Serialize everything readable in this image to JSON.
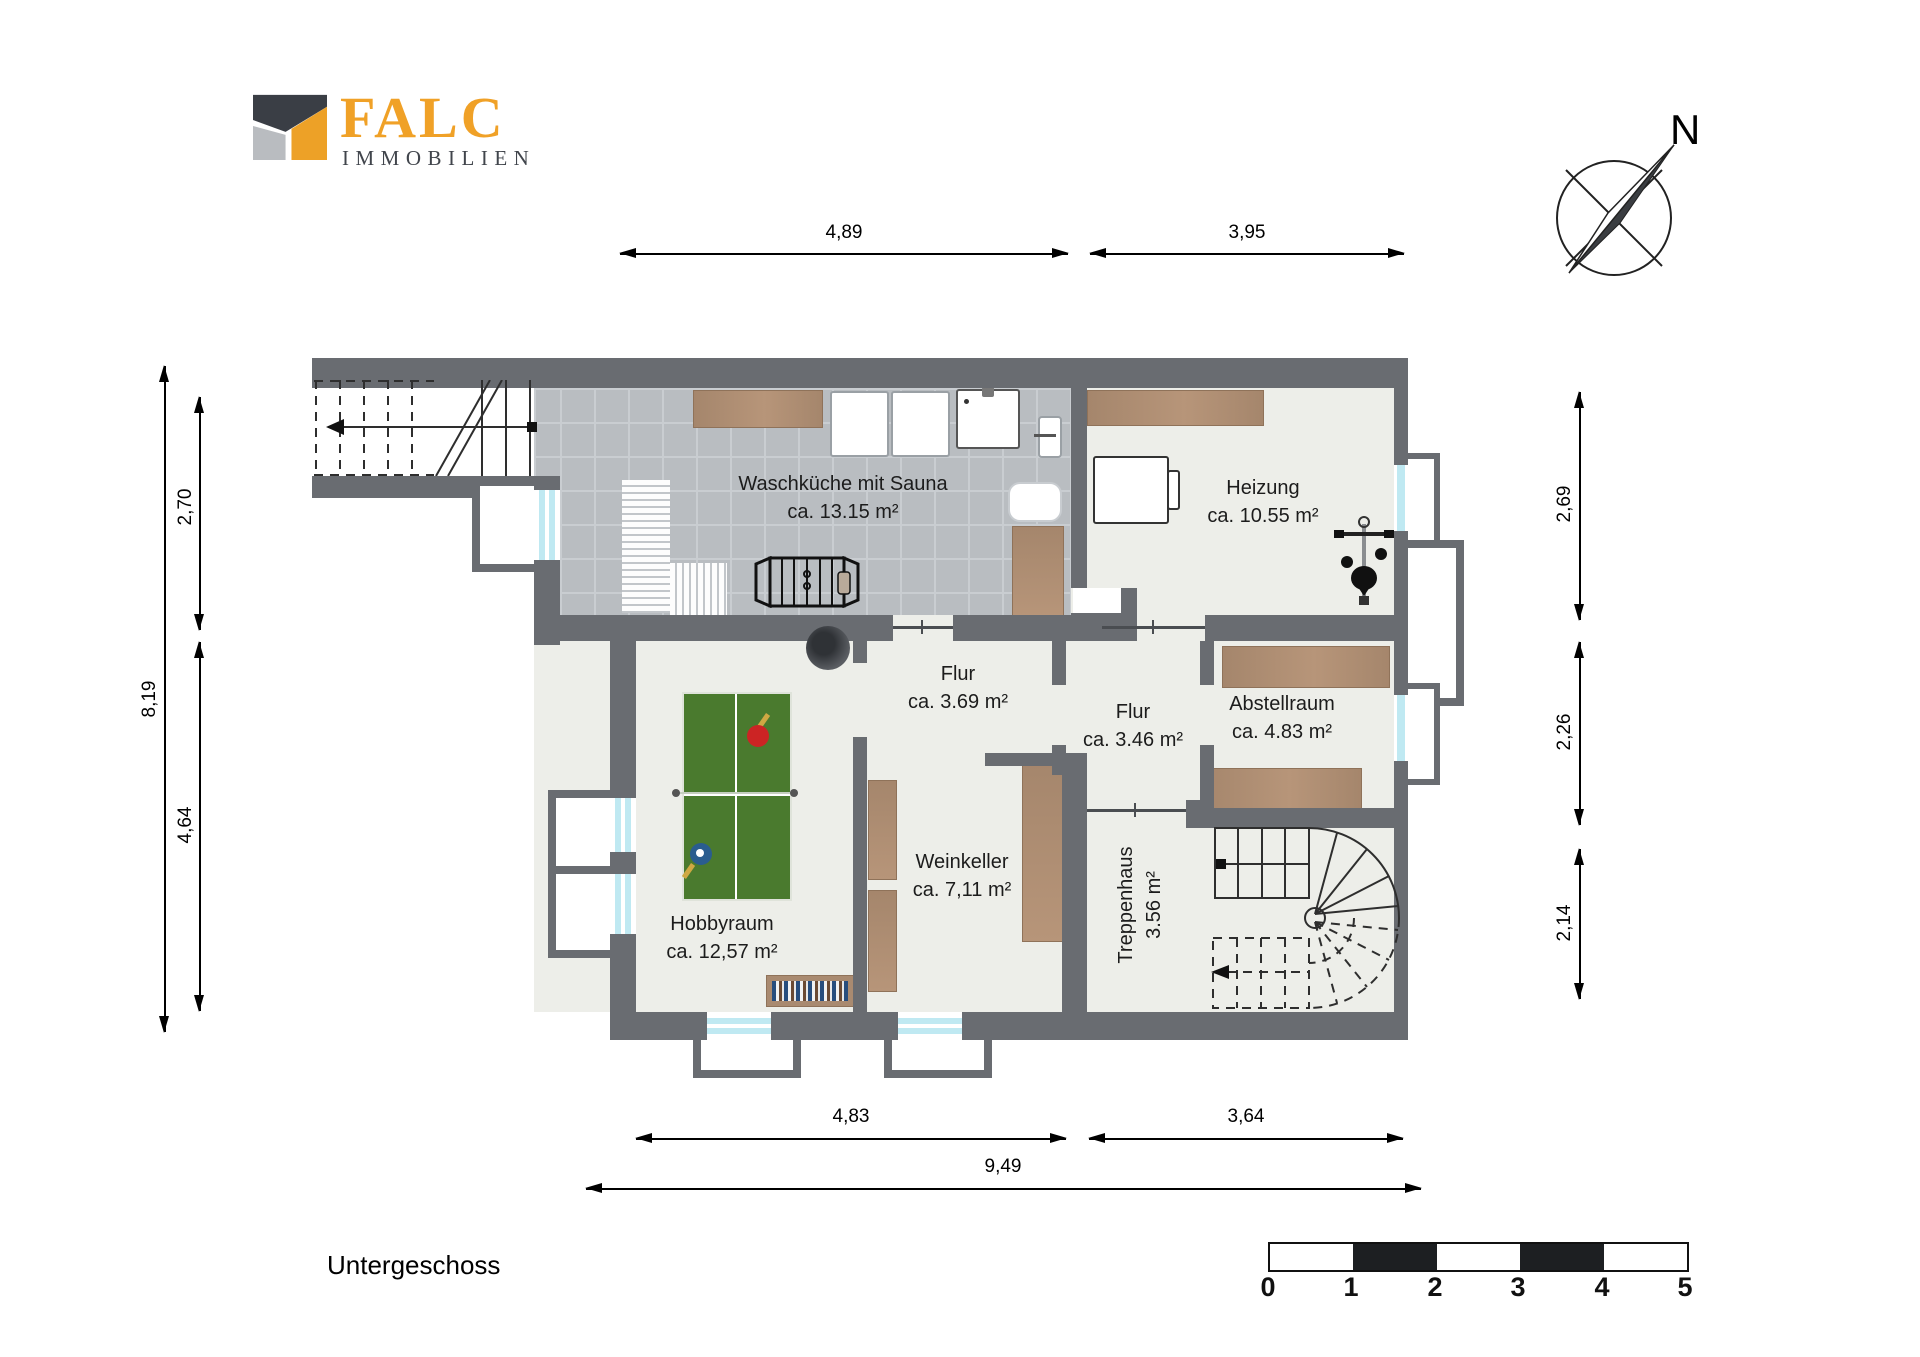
{
  "branding": {
    "name": "FALC",
    "subtitle": "IMMOBILIEN"
  },
  "compass": {
    "north_label": "N"
  },
  "plan_title": "Untergeschoss",
  "rooms": {
    "waschkueche": {
      "name": "Waschküche mit Sauna",
      "area": "ca. 13.15 m²"
    },
    "heizung": {
      "name": "Heizung",
      "area": "ca. 10.55 m²"
    },
    "flur_oben": {
      "name": "Flur",
      "area": "ca. 3.69 m²"
    },
    "flur_mitte": {
      "name": "Flur",
      "area": "ca. 3.46 m²"
    },
    "abstellraum": {
      "name": "Abstellraum",
      "area": "ca. 4.83 m²"
    },
    "hobbyraum": {
      "name": "Hobbyraum",
      "area": "ca. 12,57 m²"
    },
    "weinkeller": {
      "name": "Weinkeller",
      "area": "ca. 7,11 m²"
    },
    "treppenhaus": {
      "name": "Treppenhaus",
      "area": "3.56 m²"
    }
  },
  "dimensions": {
    "top": {
      "left": "4,89",
      "right": "3,95"
    },
    "bottom": {
      "left": "4,83",
      "right": "3,64",
      "total": "9,49"
    },
    "left": {
      "total": "8,19",
      "upper": "2,70",
      "lower": "4,64"
    },
    "right": {
      "upper": "2,69",
      "middle": "2,26",
      "lower": "2,14"
    }
  },
  "scale_bar": {
    "labels": [
      "0",
      "1",
      "2",
      "3",
      "4",
      "5"
    ]
  },
  "icons": {
    "compass": "compass-rose-icon",
    "entry_stairs": "straight-staircase-icon",
    "spiral_stairs": "winder-staircase-icon",
    "laundry": [
      "counter",
      "washing-machine",
      "washing-machine",
      "sink",
      "radiator",
      "drying-rack",
      "cabinet",
      "bench"
    ],
    "heating_room": [
      "shelf",
      "boiler",
      "exercise-bike"
    ],
    "hobby_room": [
      "table-tennis-table",
      "red-paddle",
      "blue-paddle",
      "bookshelf",
      "chimney"
    ],
    "storage": [
      "shelf",
      "shelf"
    ],
    "wine_cellar": [
      "wine-rack",
      "wine-rack",
      "wine-rack"
    ]
  },
  "colors": {
    "wall": "#696c71",
    "tile_floor": "#b9bdc1",
    "room_floor": "#edeee9",
    "wood": "#ab8b72",
    "table_green": "#4a7a2e",
    "window_glass": "#bfe9f2",
    "brand_orange": "#f0a127",
    "logo_dark": "#41454c"
  }
}
